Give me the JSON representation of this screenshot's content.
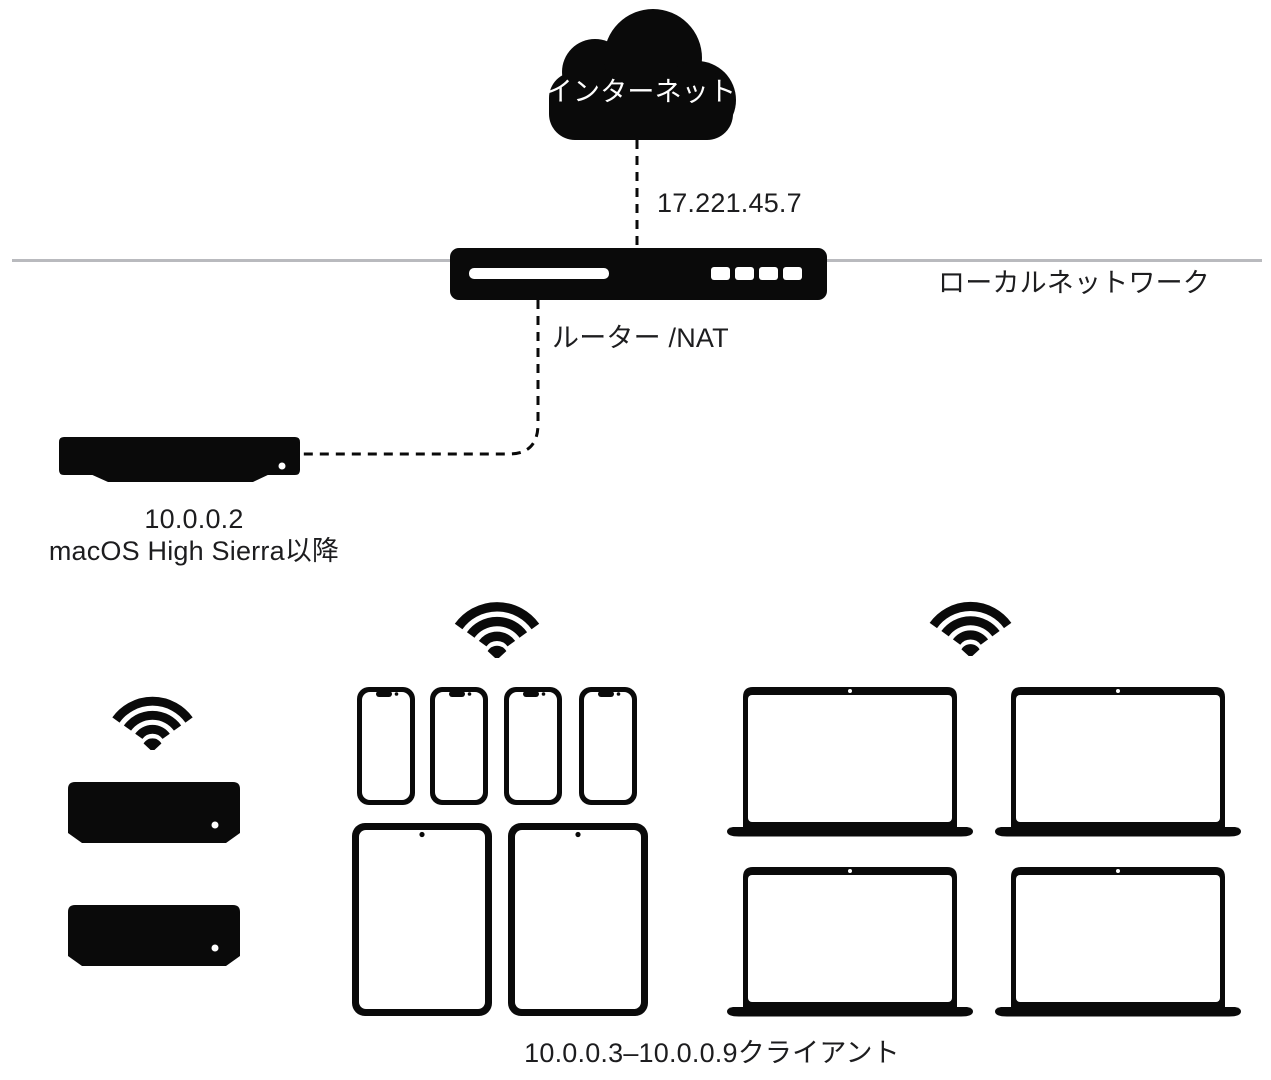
{
  "colors": {
    "device": "#0a0a0a",
    "text": "#1d1d1f",
    "line_gray": "#b9babe",
    "cloud_text": "#ffffff"
  },
  "internet": {
    "label": "インターネット",
    "wan_ip": "17.221.45.7"
  },
  "router": {
    "label": "ルーター /NAT"
  },
  "local_network": {
    "label": "ローカルネットワーク"
  },
  "server": {
    "ip": "10.0.0.2",
    "os_requirement": "macOS High Sierra以降"
  },
  "clients": {
    "range_label": "10.0.0.3–10.0.0.9クライアント"
  },
  "icons": {
    "internet": "cloud-icon",
    "wireless": "wifi-icon",
    "router": "router-device-icon",
    "server": "mac-mini-icon",
    "set_top_box": "apple-tv-icon",
    "phone": "iphone-icon",
    "tablet": "ipad-icon",
    "laptop": "macbook-icon"
  }
}
